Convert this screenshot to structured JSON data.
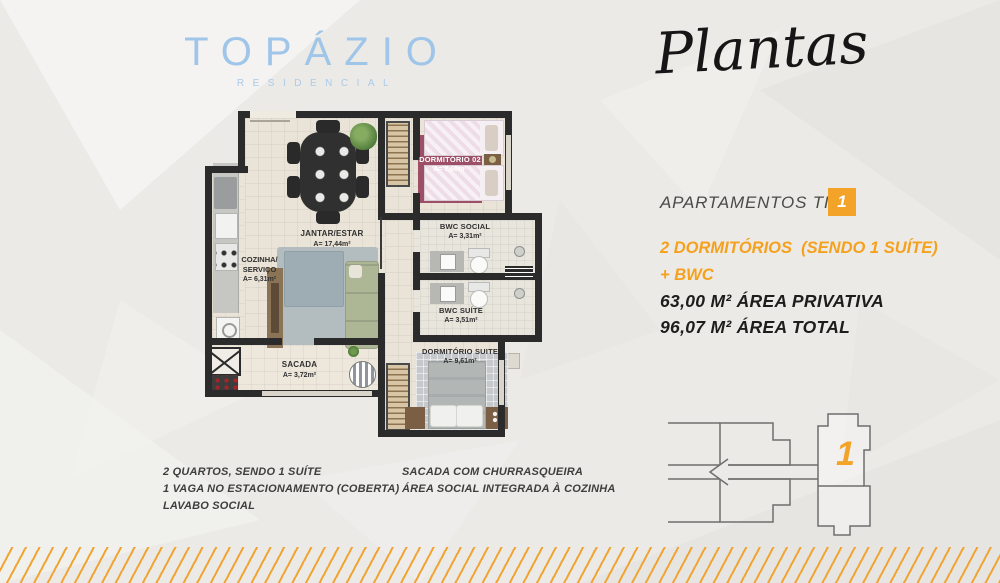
{
  "brand": {
    "name": "TOPÁZIO",
    "subtitle": "RESIDENCIAL"
  },
  "header": {
    "script_title": "Plantas"
  },
  "apartment": {
    "label": "APARTAMENTOS TIPO",
    "type_badge": "1",
    "rooms_line1": "2 DORMITÓRIOS  (SENDO 1 SUÍTE)",
    "rooms_line2": "+ BWC",
    "private_area": "63,00 M² ÁREA PRIVATIVA",
    "total_area": "96,07 M² ÁREA TOTAL"
  },
  "floor_plan": {
    "rooms": {
      "jantar_estar": {
        "name": "JANTAR/ESTAR",
        "area": "A= 17,44m²"
      },
      "cozinha": {
        "line1": "COZINHA/",
        "line2": "SERVIÇO",
        "area": "A= 6,31m²"
      },
      "sacada": {
        "name": "SACADA",
        "area": "A= 3,72m²"
      },
      "dormitorio_02": {
        "name": "DORMITÓRIO 02",
        "area": "A= 7,66m²"
      },
      "bwc_social": {
        "name": "BWC SOCIAL",
        "area": "A= 3,31m²"
      },
      "bwc_suite": {
        "name": "BWC SUÍTE",
        "area": "A= 3,51m²"
      },
      "dormitorio_suite": {
        "name": "DORMITÓRIO SUITE",
        "area": "A= 9,61m²"
      }
    }
  },
  "features": {
    "left": [
      "2 QUARTOS, SENDO 1 SUÍTE",
      "1 VAGA NO ESTACIONAMENTO (COBERTA)",
      "LAVABO SOCIAL"
    ],
    "right": [
      "SACADA COM CHURRASQUEIRA",
      "ÁREA SOCIAL INTEGRADA À COZINHA"
    ]
  },
  "key_plan": {
    "unit_number": "1"
  },
  "colors": {
    "accent_orange": "#F4A329",
    "logo_blue": "#9FC5E8",
    "wall_dark": "#2B2B2B",
    "rug_maroon": "#9C4F66"
  }
}
